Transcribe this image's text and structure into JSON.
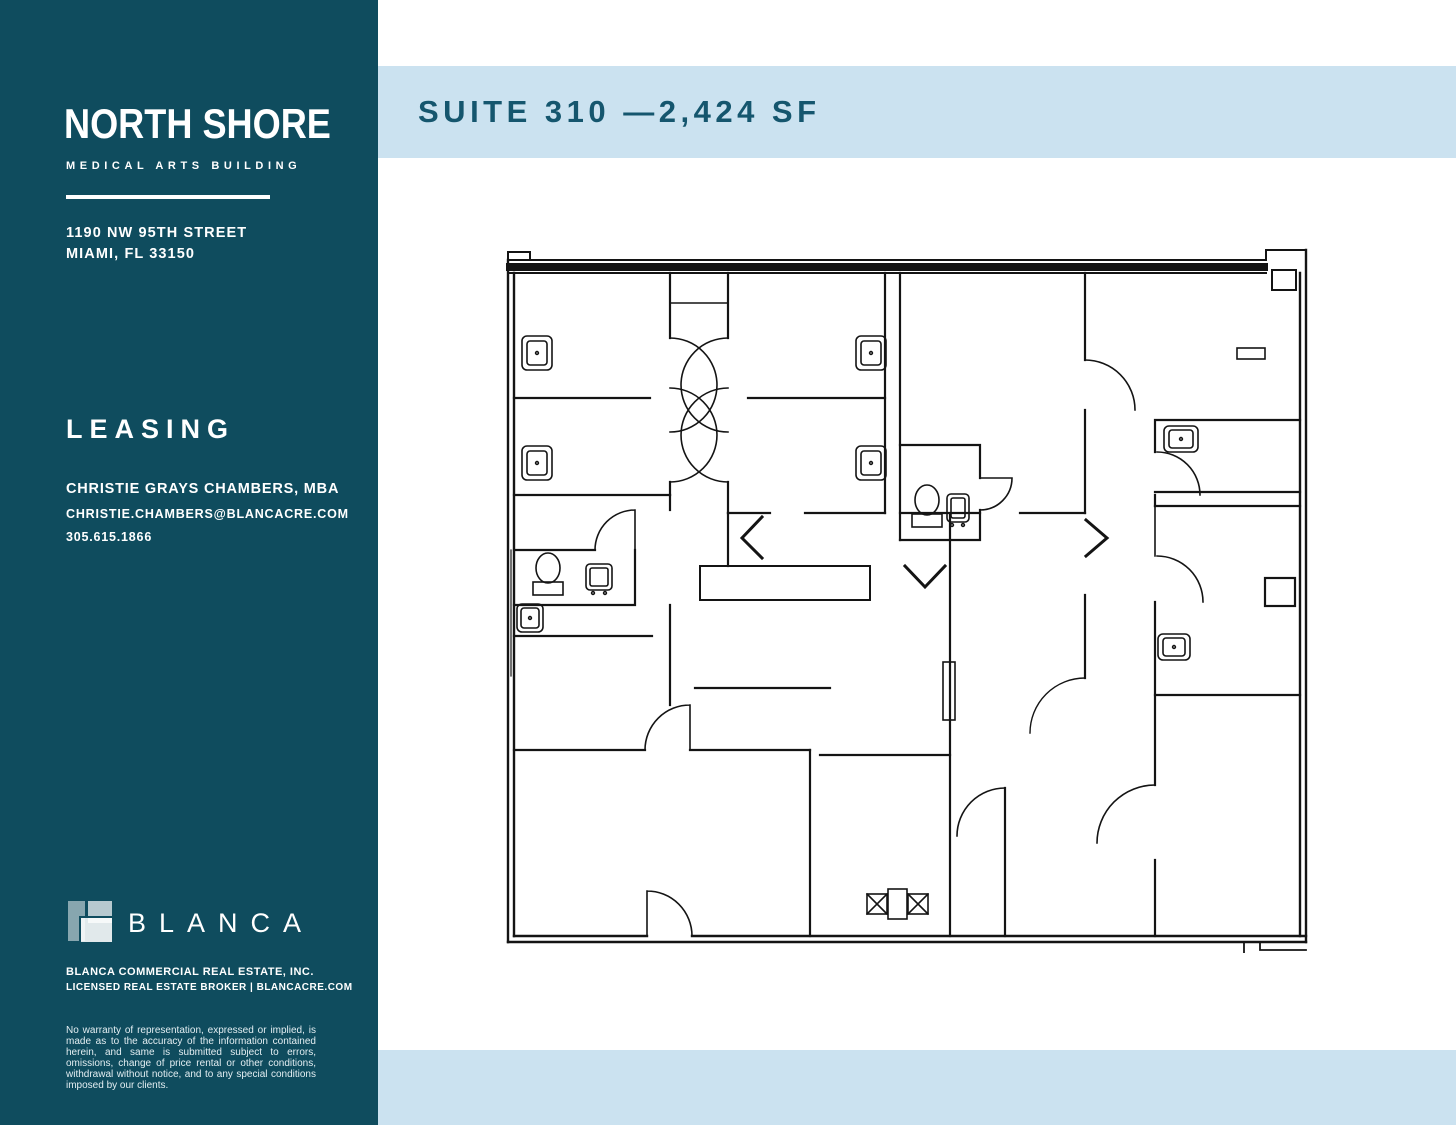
{
  "sidebar": {
    "bg_color": "#0F4C5E",
    "logo": {
      "title": "NORTH SHORE",
      "subtitle": "MEDICAL ARTS BUILDING"
    },
    "address": {
      "line1": "1190 NW 95TH STREET",
      "line2": "MIAMI, FL 33150"
    },
    "leasing": {
      "heading": "LEASING",
      "contact_name": "CHRISTIE GRAYS CHAMBERS, MBA",
      "contact_email": "CHRISTIE.CHAMBERS@BLANCACRE.COM",
      "contact_phone": "305.615.1866"
    },
    "brand": {
      "logo_text": "BLANCA",
      "company": "BLANCA COMMERCIAL REAL ESTATE, INC.",
      "license": "LICENSED REAL ESTATE BROKER | BLANCACRE.COM"
    },
    "disclaimer": "No warranty of representation, expressed or implied, is made as to the accuracy of the information contained herein, and same is submitted subject to errors, omissions, change of price rental or other conditions, withdrawal without notice, and to any special conditions imposed by our clients."
  },
  "main": {
    "title": "SUITE 310 —2,424 SF",
    "band_color": "#CBE2F0",
    "title_color": "#15566E",
    "plan_line_color": "#141414"
  }
}
